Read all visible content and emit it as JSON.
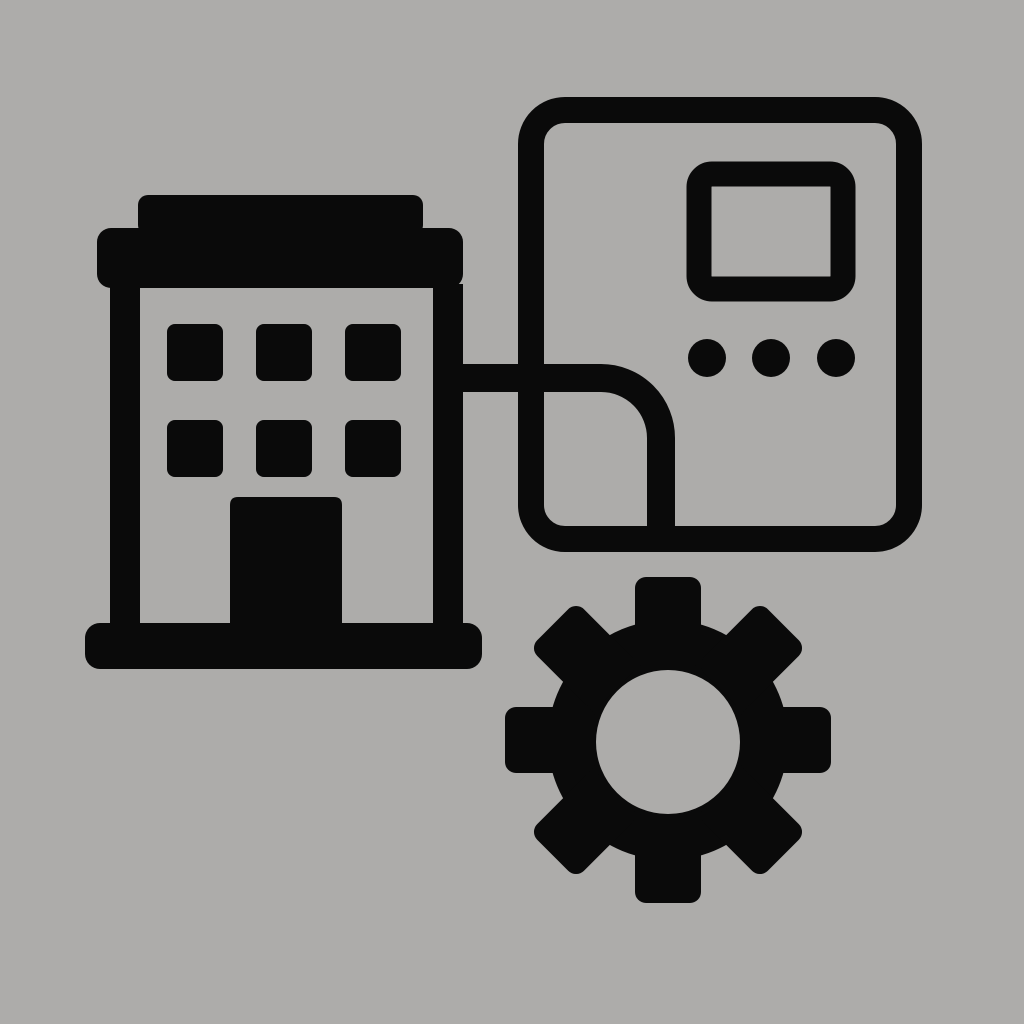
{
  "scene": {
    "title": "building-automation-pictogram",
    "background_color": "#ADACAA",
    "icon_color": "#0A0A0A"
  },
  "building": {
    "name": "building-icon",
    "window_rows": 2,
    "window_cols": 3,
    "window_count": 6,
    "has_door": true
  },
  "control_panel": {
    "name": "control-panel-icon",
    "has_screen": true,
    "button_count": 3
  },
  "gear": {
    "name": "gear-icon",
    "tooth_count": 8
  },
  "connector": {
    "name": "connector-line",
    "shape": "horizontal-then-down-elbow"
  }
}
